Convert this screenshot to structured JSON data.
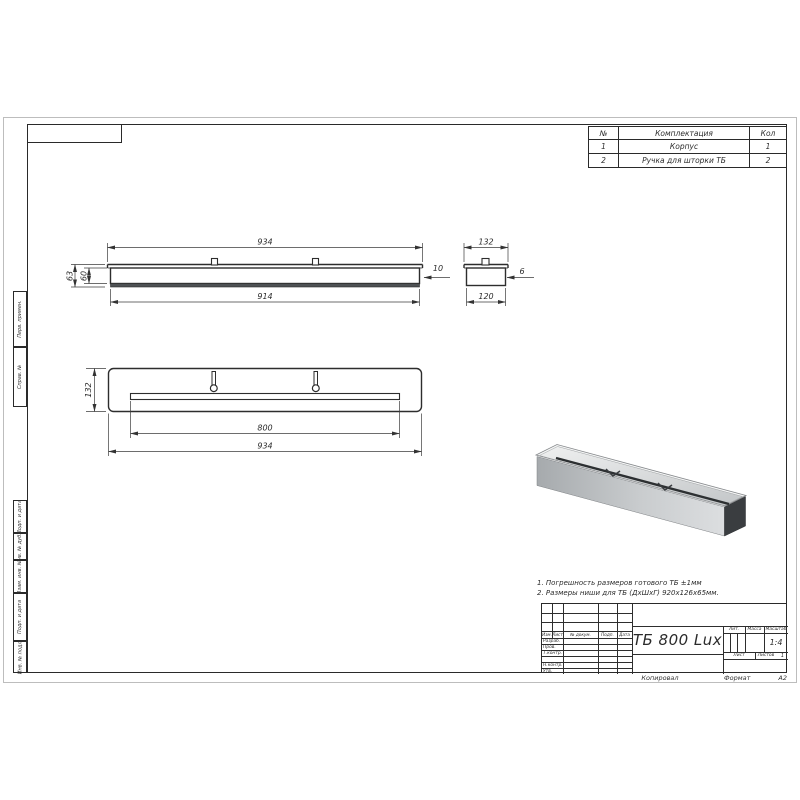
{
  "kit_table": {
    "headers": [
      "№",
      "Комплектация",
      "Кол"
    ],
    "rows": [
      [
        "1",
        "Корпус",
        "1"
      ],
      [
        "2",
        "Ручка для шторки ТБ",
        "2"
      ]
    ]
  },
  "dims": {
    "front_overall": "934",
    "front_body": "914",
    "front_height_outer": "63",
    "front_height_inner": "60",
    "front_lip": "10",
    "end_overall": "132",
    "end_body": "120",
    "end_wall": "6",
    "plan_depth": "132",
    "plan_slot": "800",
    "plan_overall": "934"
  },
  "notes": [
    "1. Погрешность размеров готового ТБ ±1мм",
    "2. Размеры ниши для ТБ (ДхШхГ) 920х126х65мм."
  ],
  "title_block": {
    "doc_title": "ТБ 800 Lux",
    "header_cols": [
      "Изм.",
      "Лист",
      "№ докум.",
      "Подп.",
      "Дата"
    ],
    "sig_rows": [
      "Разраб.",
      "Пров.",
      "Т.контр.",
      "Н.контр.",
      "Утв."
    ],
    "lit_label": "Лит.",
    "mass_label": "Масса",
    "scale_label": "Масштаб",
    "scale_value": "1:4",
    "sheet_label": "Лист",
    "sheets_label": "Листов",
    "sheets_value": "1"
  },
  "footer": {
    "copied": "Копировал",
    "format_label": "Формат",
    "format_value": "А2"
  },
  "margin_labels": [
    "Перв. примен.",
    "Справ. №",
    "Подп. и дата",
    "Инв. № дубл.",
    "Взам. инв. №",
    "Подп. и дата",
    "Инв. № подл."
  ],
  "colors": {
    "line": "#2d2d2d",
    "dim_line": "#3c3c3c",
    "metal_top": "#eceded",
    "metal_front": "#c2c5c7",
    "metal_end": "#3a3d40"
  }
}
